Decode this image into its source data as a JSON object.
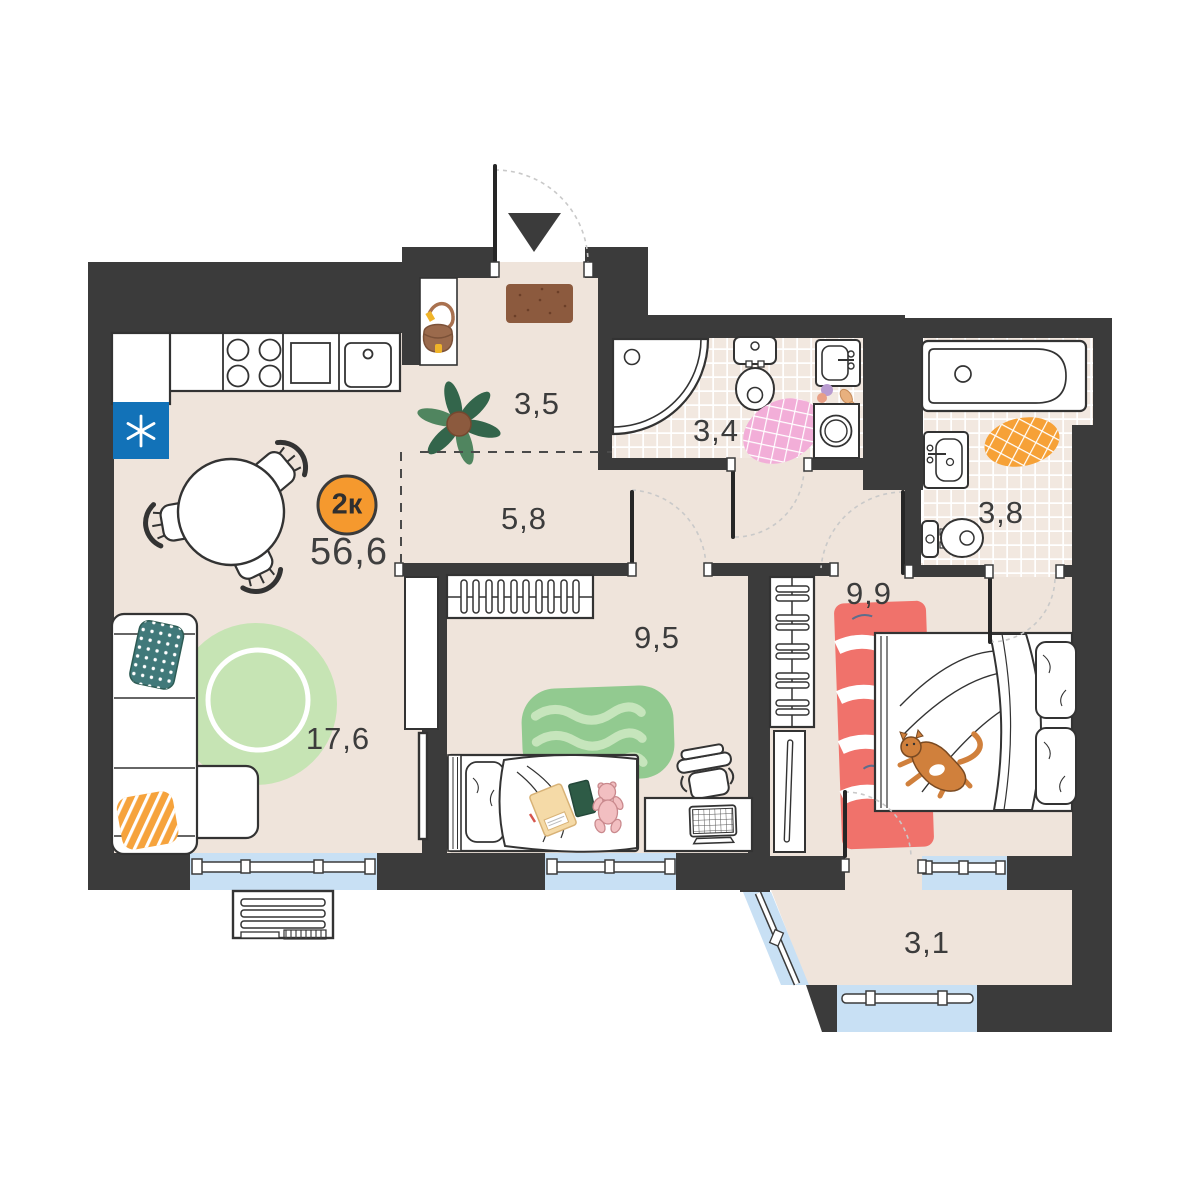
{
  "plan": {
    "badge": {
      "label": "2к"
    },
    "total_area": "56,6",
    "rooms": [
      {
        "id": "hallway",
        "area": "3,5"
      },
      {
        "id": "bathroom",
        "area": "3,4"
      },
      {
        "id": "corridor",
        "area": "5,8"
      },
      {
        "id": "bathroom-2",
        "area": "3,8"
      },
      {
        "id": "bedroom",
        "area": "9,9"
      },
      {
        "id": "children-room",
        "area": "9,5"
      },
      {
        "id": "kitchen-living-room",
        "area": "17,6"
      },
      {
        "id": "balcony",
        "area": "3,1"
      }
    ],
    "icons": {
      "entry_arrow": "entry-arrow-icon",
      "fridge_snowflake": "snowflake-icon"
    },
    "colors": {
      "wall": "#3B3B3B",
      "floor": "#EFE4DB",
      "tile": "#F2E8E0",
      "window_glass": "#C8E0F4",
      "badge": "#F5992E",
      "fridge": "#1272B8",
      "rug_green": "#92CA90",
      "rug_round_green": "#C6E4B4",
      "rug_red": "#F0726B",
      "rug_pink": "#F2AED8",
      "rug_orange": "#F6A137",
      "pillow_teal": "#41797A",
      "pillow_orange": "#F6A33C",
      "doormat": "#8C5A3E",
      "cat": "#D0803C"
    }
  }
}
